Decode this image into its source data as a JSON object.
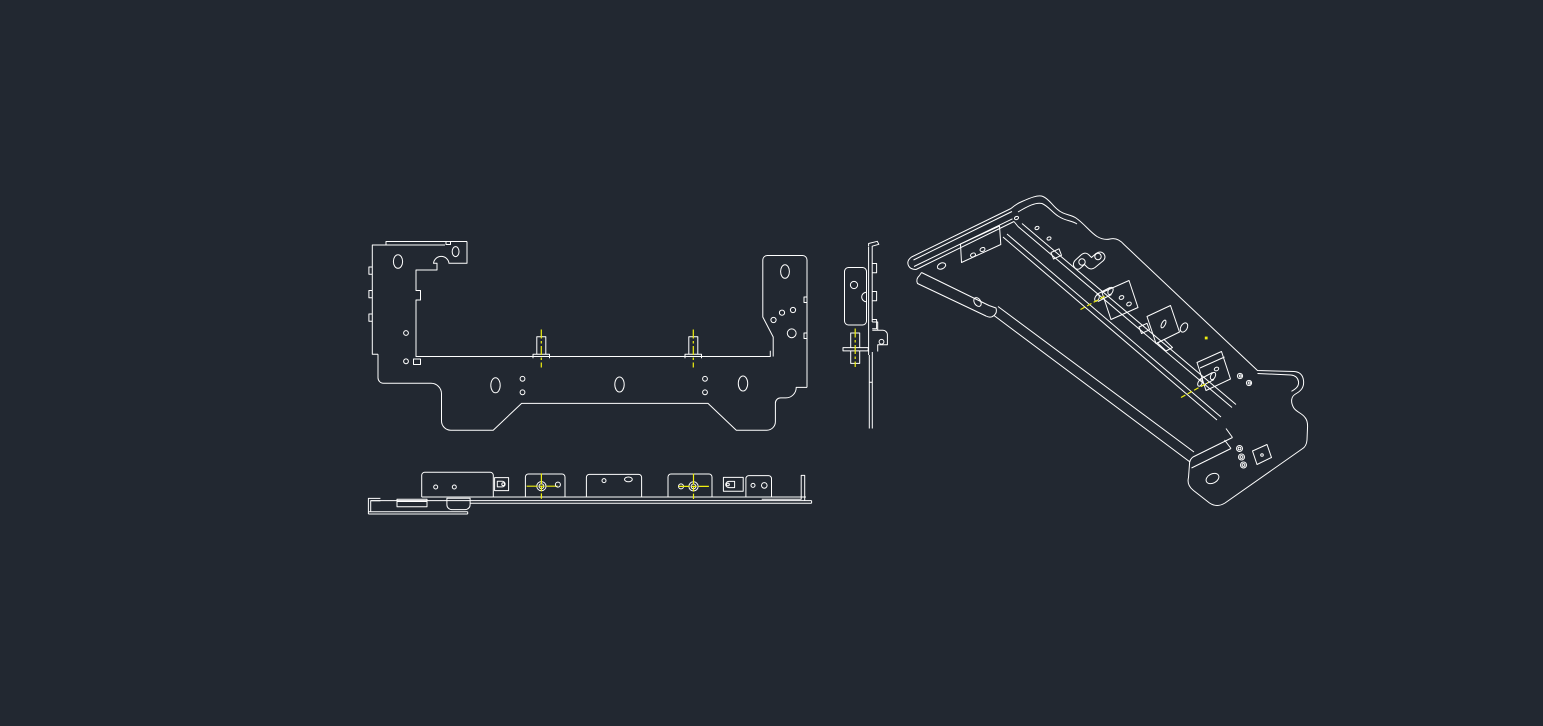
{
  "app": {
    "kind": "cad-model-space-viewport",
    "description": "Dark CAD viewport showing wireframe views of a sheet-metal bracket"
  },
  "colors": {
    "background": "#222831",
    "line": "#ffffff",
    "centerline": "#efef10"
  },
  "views": [
    {
      "id": "front-view",
      "label": "Front view of bracket",
      "position": "top-left"
    },
    {
      "id": "side-view",
      "label": "Side view of bracket",
      "position": "center"
    },
    {
      "id": "bottom-view",
      "label": "Bottom view of bracket",
      "position": "bottom-left"
    },
    {
      "id": "isometric-view",
      "label": "Isometric view of bracket",
      "position": "right"
    }
  ],
  "markers": {
    "front_stud_centerlines": 2,
    "bottom_stud_crosshairs": 2,
    "side_stud_centerlines": 1,
    "iso_stud_centerlines": 2,
    "iso_point_markers": 1
  }
}
